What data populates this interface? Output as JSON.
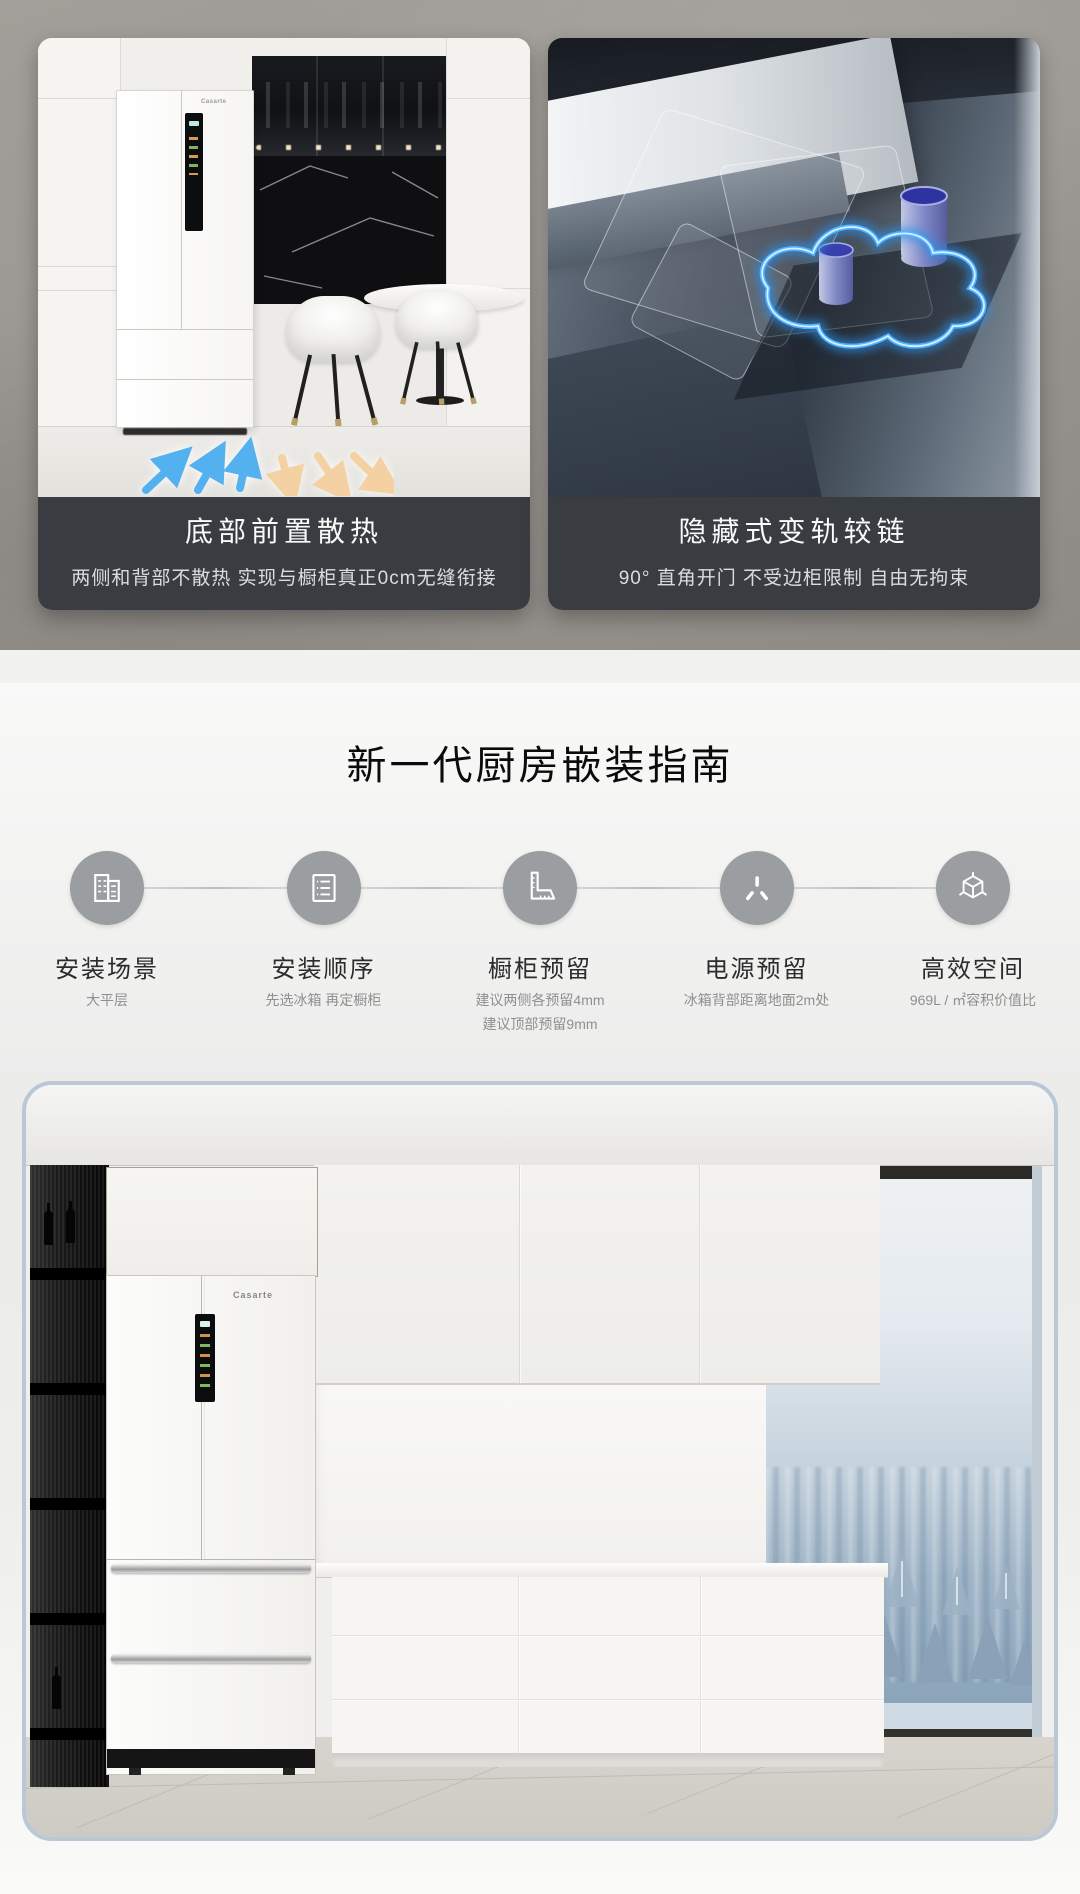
{
  "features": {
    "cards": [
      {
        "title": "底部前置散热",
        "subtitle": "两侧和背部不散热 实现与橱柜真正0cm无缝衔接"
      },
      {
        "title": "隐藏式变轨较链",
        "subtitle": "90° 直角开门 不受边柜限制 自由无拘束"
      }
    ]
  },
  "guide": {
    "title": "新一代厨房嵌装指南",
    "steps": [
      {
        "label": "安装场景",
        "icon": "buildings-icon",
        "notes": [
          "大平层"
        ]
      },
      {
        "label": "安装顺序",
        "icon": "list-icon",
        "notes": [
          "先选冰箱 再定橱柜"
        ]
      },
      {
        "label": "橱柜预留",
        "icon": "square-ruler-icon",
        "notes": [
          "建议两侧各预留4mm",
          "建议顶部预留9mm"
        ]
      },
      {
        "label": "电源预留",
        "icon": "power-socket-icon",
        "notes": [
          "冰箱背部距离地面2m处"
        ]
      },
      {
        "label": "高效空间",
        "icon": "cube-icon",
        "notes": [
          "969L / ㎡容积价值比"
        ]
      }
    ]
  },
  "render": {
    "brand_logo": "Casarte"
  },
  "colors": {
    "caption_bg": "#393d42",
    "hero_wall": "#9a9691",
    "step_circle": "#9b9ea1",
    "glow_blue": "#3fa9ff",
    "arrow_blue": "#54b1f0",
    "arrow_orange": "#f6cf9d",
    "render_card_border": "#b9c7d7"
  }
}
